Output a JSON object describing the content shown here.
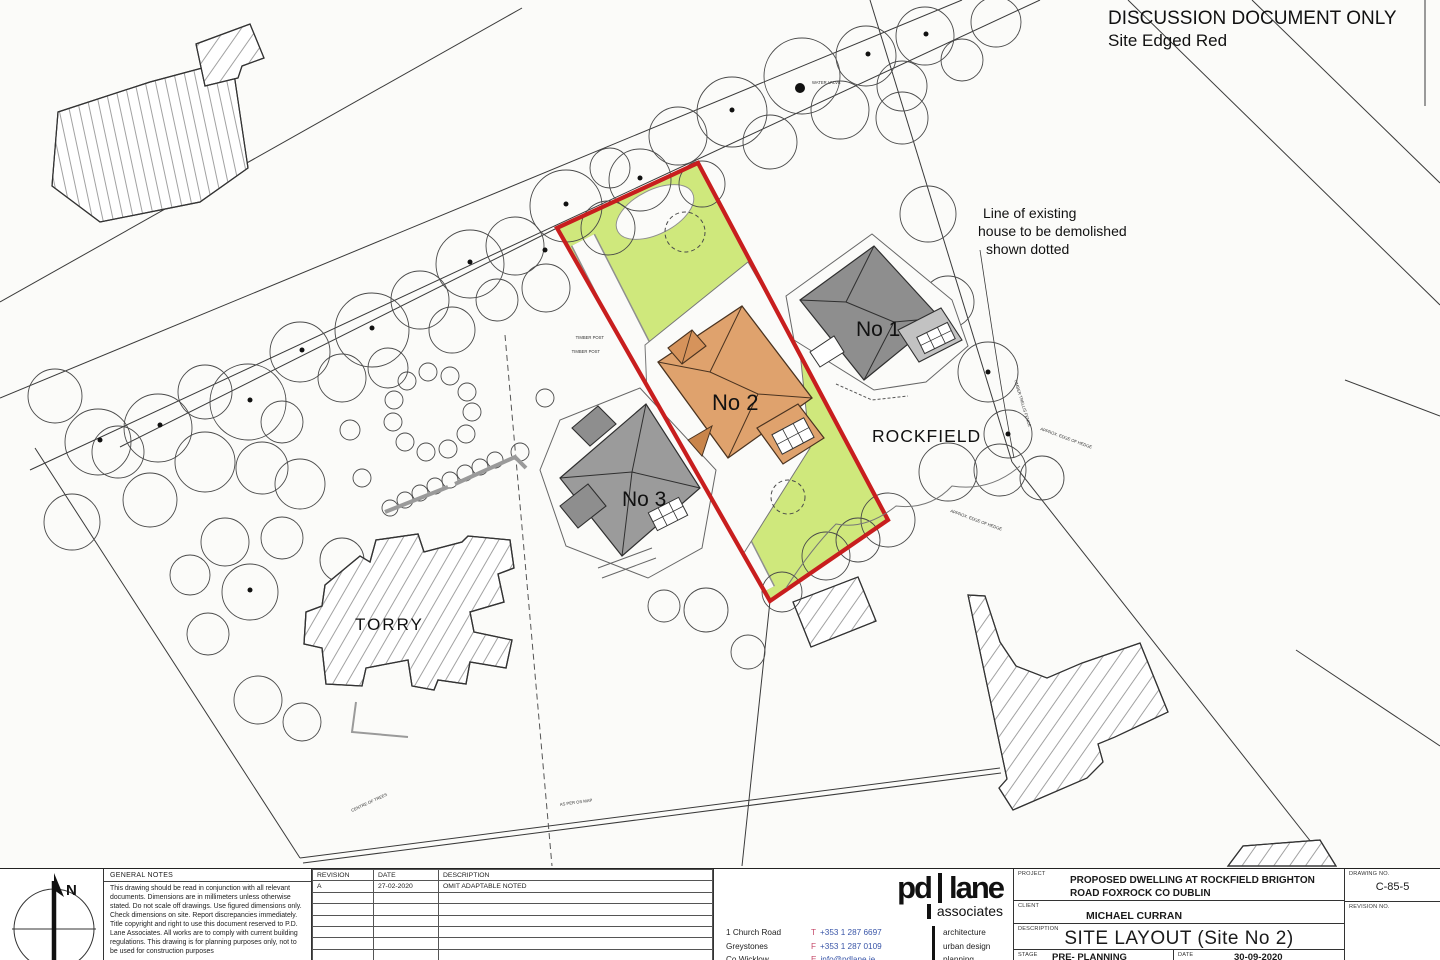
{
  "header": {
    "doc_status": "DISCUSSION DOCUMENT ONLY",
    "doc_note": "Site Edged Red"
  },
  "plan": {
    "labels": {
      "no1": "No 1",
      "no2": "No 2",
      "no3": "No 3",
      "rockfield": "ROCKFIELD",
      "torry": "TORRY"
    },
    "demolish_note": {
      "l1": "Line of existing",
      "l2": "house to be demolished",
      "l3": "shown dotted"
    },
    "micro": {
      "timber_post": "TIMBER POST",
      "water_valve": "WATER VALVE",
      "trellis_fence": "TIMBER TRELLIS FENCE",
      "edge_of_hedge": "APPROX. EDGE OF HEDGE",
      "centre_of_trees": "CENTRE OF TREES",
      "os_map": "AS PER OS MAP"
    },
    "colors": {
      "site_boundary": "#c81e1e",
      "site_fill": "#cfe87c",
      "proposed_house": "#dfa26d",
      "existing_houses": "#9a9a9a"
    }
  },
  "titleblock": {
    "north_label": "N",
    "general_notes": {
      "title": "GENERAL NOTES",
      "body": "This drawing should be read in conjunction with all relevant documents. Dimensions are in millimeters unless otherwise stated. Do not scale off drawings. Use figured dimensions only. Check dimensions on site. Report discrepancies immediately. Title copyright and right to use this document reserved to P.D. Lane Associates. All works are to comply with current building regulations. This drawing is for planning purposes only, not to be used for construction purposes"
    },
    "revisions": {
      "headers": [
        "REVISION",
        "DATE",
        "DESCRIPTION"
      ],
      "rows": [
        {
          "revision": "A",
          "date": "27-02-2020",
          "description": "OMIT ADAPTABLE NOTED"
        }
      ]
    },
    "firm": {
      "logo_main_left": "pd",
      "logo_main_right": "lane",
      "logo_sub": "associates",
      "address": [
        "1 Church Road",
        "Greystones",
        "Co Wicklow"
      ],
      "contacts": [
        {
          "label": "T",
          "value": "+353 1 287 6697"
        },
        {
          "label": "F",
          "value": "+353 1 287 0109"
        },
        {
          "label": "E",
          "value": "info@pdlane.ie"
        }
      ],
      "services": [
        "architecture",
        "urban design",
        "planning"
      ]
    },
    "project": {
      "project_label": "PROJECT",
      "project_value": "PROPOSED DWELLING AT ROCKFIELD BRIGHTON ROAD FOXROCK CO DUBLIN",
      "drawing_no_label": "DRAWING NO.",
      "drawing_no_value": "C-85-5",
      "client_label": "CLIENT",
      "client_value": "MICHAEL CURRAN",
      "revision_no_label": "REVISION NO.",
      "revision_no_value": "",
      "description_label": "DESCRIPTION",
      "description_value": "SITE LAYOUT (Site No 2)",
      "stage_label": "STAGE",
      "stage_value": "PRE- PLANNING",
      "date_label": "DATE",
      "date_value": "30-09-2020"
    }
  }
}
